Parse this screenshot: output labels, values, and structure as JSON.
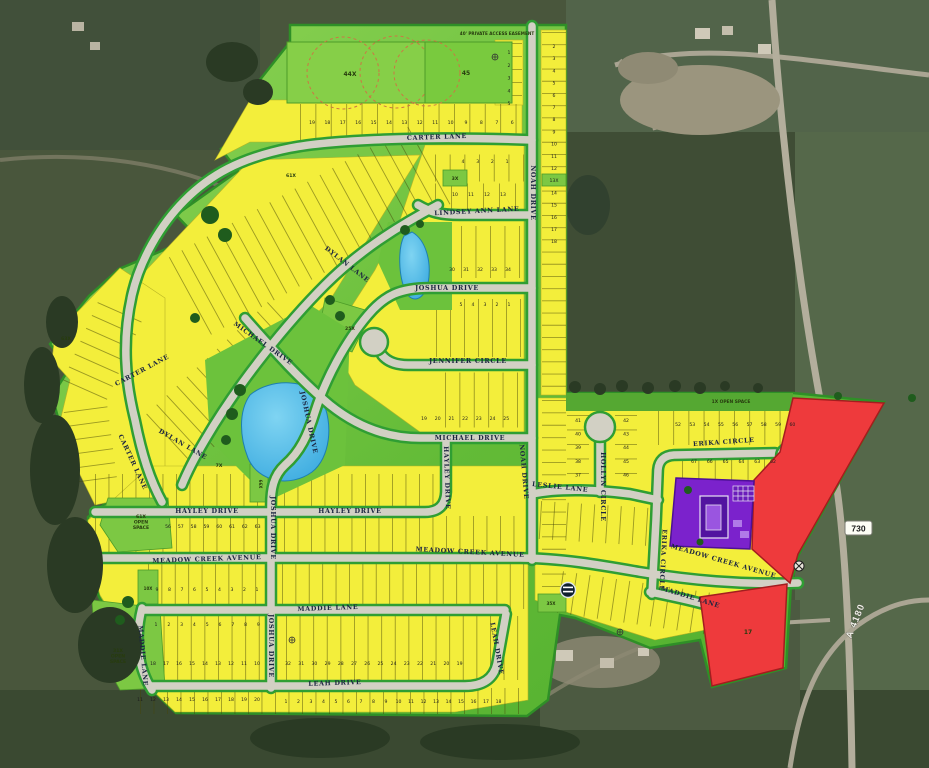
{
  "map": {
    "description": "Residential subdivision plat over aerial imagery",
    "easement_label": "40' PRIVATE ACCESS EASEMENT",
    "road_labels": {
      "shield": "730",
      "highway": "A 4180"
    },
    "street_labels": [
      {
        "text": "CARTER LANE",
        "x": 437,
        "y": 139,
        "rot": -2
      },
      {
        "text": "CARTER LANE",
        "x": 143,
        "y": 372,
        "rot": -28
      },
      {
        "text": "CARTER LANE",
        "x": 131,
        "y": 463,
        "rot": 65
      },
      {
        "text": "LINDSEY ANN LANE",
        "x": 477,
        "y": 213,
        "rot": -3
      },
      {
        "text": "DYLAN LANE",
        "x": 346,
        "y": 266,
        "rot": 38
      },
      {
        "text": "DYLAN LANE",
        "x": 182,
        "y": 446,
        "rot": 30
      },
      {
        "text": "NOAH DRIVE",
        "x": 531,
        "y": 193,
        "rot": 90
      },
      {
        "text": "NOAH DRIVE",
        "x": 522,
        "y": 472,
        "rot": 85
      },
      {
        "text": "JOSHUA DRIVE",
        "x": 447,
        "y": 290,
        "rot": 0
      },
      {
        "text": "JOSHUA DRIVE",
        "x": 307,
        "y": 423,
        "rot": 78
      },
      {
        "text": "JOSHUA DRIVE",
        "x": 271,
        "y": 528,
        "rot": 90
      },
      {
        "text": "JOSHUA DRIVE",
        "x": 269,
        "y": 646,
        "rot": 90
      },
      {
        "text": "JENNIFER CIRCLE",
        "x": 468,
        "y": 363,
        "rot": 0
      },
      {
        "text": "MICHAEL DRIVE",
        "x": 262,
        "y": 345,
        "rot": 35
      },
      {
        "text": "MICHAEL DRIVE",
        "x": 470,
        "y": 440,
        "rot": 0
      },
      {
        "text": "LESLIE LANE",
        "x": 560,
        "y": 489,
        "rot": 6
      },
      {
        "text": "HOLLYN CIRCLE",
        "x": 601,
        "y": 487,
        "rot": 90
      },
      {
        "text": "ERIKA CIRCLE",
        "x": 724,
        "y": 444,
        "rot": -4
      },
      {
        "text": "ERIKA CIRCLE",
        "x": 661,
        "y": 560,
        "rot": 93
      },
      {
        "text": "HAYLEY DRIVE",
        "x": 207,
        "y": 513,
        "rot": 0
      },
      {
        "text": "HAYLEY DRIVE",
        "x": 350,
        "y": 513,
        "rot": 0
      },
      {
        "text": "HAYLEY DRIVE",
        "x": 445,
        "y": 478,
        "rot": 88
      },
      {
        "text": "MEADOW CREEK AVENUE",
        "x": 207,
        "y": 561,
        "rot": -2
      },
      {
        "text": "MEADOW CREEK AVENUE",
        "x": 470,
        "y": 554,
        "rot": 3
      },
      {
        "text": "MEADOW CREEK AVENUE",
        "x": 723,
        "y": 563,
        "rot": 16
      },
      {
        "text": "MADDIE LANE",
        "x": 328,
        "y": 610,
        "rot": -2
      },
      {
        "text": "MADDIE LANE",
        "x": 141,
        "y": 656,
        "rot": 85
      },
      {
        "text": "MADDIE LANE",
        "x": 690,
        "y": 599,
        "rot": 17
      },
      {
        "text": "LEAH DRIVE",
        "x": 335,
        "y": 685,
        "rot": -2
      },
      {
        "text": "LEAH DRIVE",
        "x": 495,
        "y": 649,
        "rot": 80
      }
    ],
    "area_labels": [
      {
        "t": "40' PRIVATE ACCESS EASEMENT",
        "x": 497,
        "y": 35,
        "s": 4.2
      },
      {
        "t": "44X",
        "x": 350,
        "y": 76,
        "s": 6
      },
      {
        "t": "45",
        "x": 466,
        "y": 75,
        "s": 6
      },
      {
        "t": "3X",
        "x": 455,
        "y": 180,
        "s": 4.6
      },
      {
        "t": "61X",
        "x": 291,
        "y": 177,
        "s": 4.6
      },
      {
        "t": "63X",
        "x": 66,
        "y": 340,
        "s": 4.6
      },
      {
        "t": "25X",
        "x": 350,
        "y": 330,
        "s": 4.6
      },
      {
        "t": "7X",
        "x": 219,
        "y": 467,
        "s": 4.6
      },
      {
        "t": "66X",
        "x": 259,
        "y": 484,
        "s": 4.0,
        "rot": 90
      },
      {
        "lines": [
          "61X",
          "OPEN",
          "SPACE"
        ],
        "x": 141,
        "y": 518,
        "s": 4.6
      },
      {
        "t": "10X",
        "x": 148,
        "y": 590,
        "s": 4.0
      },
      {
        "lines": [
          "31X",
          "OPEN",
          "SPACE"
        ],
        "x": 118,
        "y": 652,
        "s": 4.6
      },
      {
        "t": "1X OPEN SPACE",
        "x": 731,
        "y": 403,
        "s": 4.4
      },
      {
        "t": "35X",
        "x": 551,
        "y": 605,
        "s": 4.2
      },
      {
        "t": "17",
        "x": 748,
        "y": 634,
        "s": 6
      }
    ],
    "lot_blocks": [
      {
        "name": "carter-lane-north",
        "numbers": [
          "19",
          "18",
          "17",
          "16",
          "15",
          "14",
          "13",
          "12",
          "11",
          "10",
          "9",
          "8",
          "7",
          "6"
        ],
        "x": 312,
        "y": 124,
        "dx": 15.4,
        "dy": 0
      },
      {
        "name": "noah-west-column",
        "numbers": [
          "1",
          "2",
          "3",
          "4",
          "5"
        ],
        "x": 509,
        "y": 54,
        "dx": 0,
        "dy": 12.8
      },
      {
        "name": "noah-east-column",
        "numbers": [
          "2",
          "3",
          "4",
          "5",
          "6",
          "7",
          "8",
          "9",
          "10",
          "11",
          "12",
          "13X",
          "14",
          "15",
          "16",
          "17",
          "18"
        ],
        "x": 554,
        "y": 48,
        "dx": 0,
        "dy": 12.2
      },
      {
        "name": "lindsey-row-a",
        "numbers": [
          "4",
          "3",
          "2",
          "1"
        ],
        "x": 463,
        "y": 163,
        "dx": 14.7,
        "dy": 0
      },
      {
        "name": "lindsey-row-b",
        "numbers": [
          "10",
          "11",
          "12",
          "13"
        ],
        "x": 455,
        "y": 196,
        "dx": 16,
        "dy": 0
      },
      {
        "name": "joshua-north-row",
        "numbers": [
          "30",
          "31",
          "32",
          "33",
          "34"
        ],
        "x": 452,
        "y": 271,
        "dx": 14,
        "dy": 0
      },
      {
        "name": "joshua-south-row",
        "numbers": [
          "5",
          "4",
          "3",
          "2",
          "1"
        ],
        "x": 461,
        "y": 306,
        "dx": 12,
        "dy": 0
      },
      {
        "name": "michael-north-row",
        "numbers": [
          "19",
          "20",
          "21",
          "22",
          "23",
          "24",
          "25"
        ],
        "x": 424,
        "y": 420,
        "dx": 13.7,
        "dy": 0
      },
      {
        "name": "erika-north-row",
        "numbers": [
          "52",
          "53",
          "54",
          "55",
          "56",
          "57",
          "58",
          "59",
          "60"
        ],
        "x": 678,
        "y": 426,
        "dx": 14.3,
        "dy": 0
      },
      {
        "name": "erika-south-row",
        "numbers": [
          "67",
          "66",
          "65",
          "64",
          "63",
          "62"
        ],
        "x": 694,
        "y": 463,
        "dx": 15.8,
        "dy": 0
      },
      {
        "name": "hollyn-west-column",
        "numbers": [
          "41",
          "40",
          "39",
          "38",
          "37"
        ],
        "x": 578,
        "y": 422,
        "dx": 0,
        "dy": 13.6
      },
      {
        "name": "hollyn-east-column",
        "numbers": [
          "42",
          "43",
          "44",
          "45",
          "46"
        ],
        "x": 626,
        "y": 422,
        "dx": 0,
        "dy": 13.6
      },
      {
        "name": "hayley-north-row",
        "numbers": [
          "56",
          "57",
          "58",
          "59",
          "60",
          "61",
          "62",
          "63"
        ],
        "x": 168,
        "y": 528,
        "dx": 12.8,
        "dy": 0
      },
      {
        "name": "meadow-south-row",
        "numbers": [
          "9",
          "8",
          "7",
          "6",
          "5",
          "4",
          "3",
          "2",
          "1"
        ],
        "x": 157,
        "y": 591,
        "dx": 12.5,
        "dy": 0
      },
      {
        "name": "maddie-north-row",
        "numbers": [
          "1",
          "2",
          "3",
          "4",
          "5",
          "6",
          "7",
          "8",
          "9"
        ],
        "x": 156,
        "y": 626,
        "dx": 12.8,
        "dy": 0
      },
      {
        "name": "maddie-south-row",
        "numbers": [
          "18",
          "17",
          "16",
          "15",
          "14",
          "13",
          "12",
          "11",
          "10"
        ],
        "x": 153,
        "y": 665,
        "dx": 13,
        "dy": 0
      },
      {
        "name": "leah-north-row",
        "numbers": [
          "32",
          "31",
          "30",
          "29",
          "28",
          "27",
          "26",
          "25",
          "24",
          "23",
          "22",
          "21",
          "20",
          "19"
        ],
        "x": 288,
        "y": 665,
        "dx": 13.2,
        "dy": 0
      },
      {
        "name": "leah-south-row",
        "numbers": [
          "1",
          "2",
          "3",
          "4",
          "5",
          "6",
          "7",
          "8",
          "9",
          "10",
          "11",
          "12",
          "13",
          "14",
          "15",
          "16",
          "17",
          "18"
        ],
        "x": 286,
        "y": 703,
        "dx": 12.5,
        "dy": 0
      },
      {
        "name": "leah-southwest-row",
        "numbers": [
          "11",
          "12",
          "13",
          "14",
          "15",
          "16",
          "17",
          "18",
          "19",
          "20"
        ],
        "x": 140,
        "y": 701,
        "dx": 13,
        "dy": 0
      }
    ],
    "colors": {
      "lot_yellow": "#f3ee3b",
      "open_green": "#7cc843",
      "boundary_green": "#3da52f",
      "street_gray": "#d2d0c4",
      "pond_blue": "#41b4e6",
      "parcel_red": "#ee3a3c",
      "parcel_purple": "#7b22cc",
      "aerial_base": "#49563c",
      "label_navy": "#1b2540"
    }
  }
}
